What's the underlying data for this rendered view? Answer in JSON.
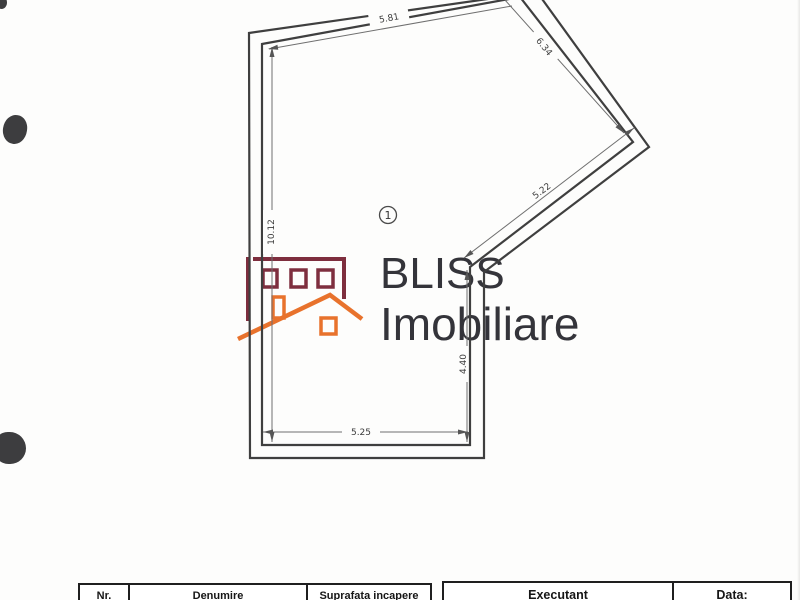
{
  "plan": {
    "room_marker": "1",
    "dimensions": {
      "top_left_wall": "5.81",
      "top_right_wall": "6.34",
      "diagonal_wall": "5.22",
      "left_wall": "10.12",
      "right_wall": "4.40",
      "bottom_wall": "5.25"
    }
  },
  "logo": {
    "brand": "BLISS",
    "subtitle": "Imobiliare",
    "colors": {
      "building_maroon": "#7e2e3e",
      "roof_orange": "#e8722c",
      "text_dark": "#34343a"
    }
  },
  "title_block": {
    "room_table_headers": [
      "Nr.",
      "Denumire",
      "Suprafata incapere"
    ],
    "signature_table_headers": [
      "Executant",
      "Data:"
    ]
  }
}
